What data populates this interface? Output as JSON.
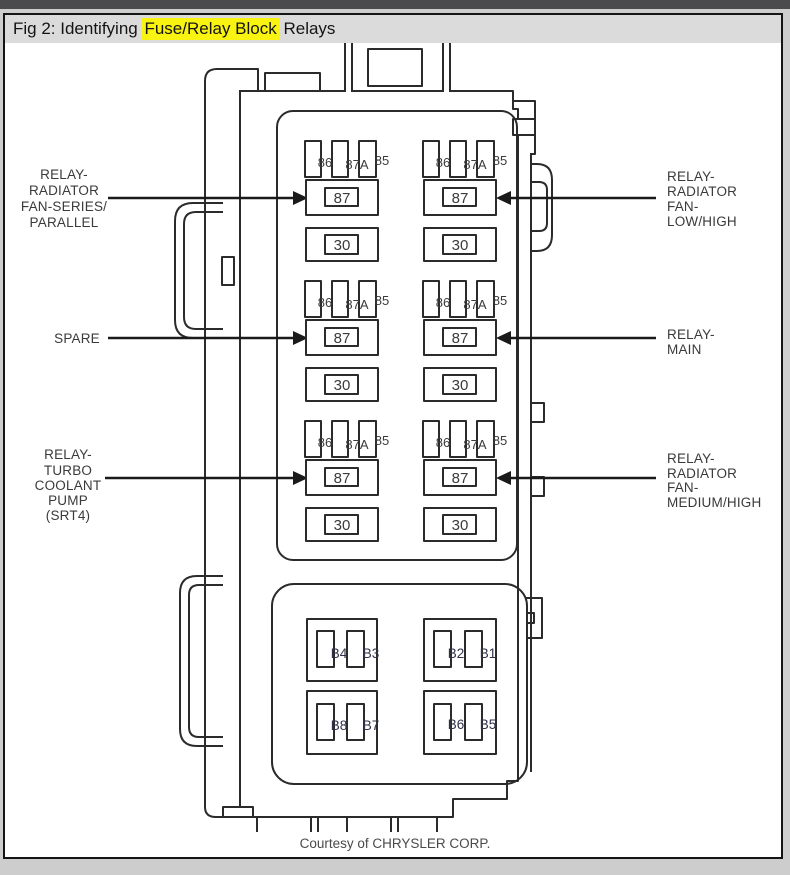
{
  "header": {
    "title_prefix": "Fig 2: Identifying ",
    "title_highlight": "Fuse/Relay Block",
    "title_suffix": " Relays",
    "highlight_color": "#f8f310",
    "background": "#dbdbdb"
  },
  "diagram": {
    "terminals": {
      "coil_a": "86",
      "coil_b": "87A",
      "coil_c": "85",
      "output": "87",
      "power": "30"
    },
    "callouts": {
      "left": [
        {
          "lines": [
            "RELAY-",
            "RADIATOR",
            "FAN-SERIES/",
            "PARALLEL"
          ]
        },
        {
          "lines": [
            "SPARE"
          ]
        },
        {
          "lines": [
            "RELAY-",
            "TURBO",
            "COOLANT",
            "PUMP",
            "(SRT4)"
          ]
        }
      ],
      "right": [
        {
          "lines": [
            "RELAY-",
            "RADIATOR",
            "FAN-",
            "LOW/HIGH"
          ]
        },
        {
          "lines": [
            "RELAY-",
            "MAIN"
          ]
        },
        {
          "lines": [
            "RELAY-",
            "RADIATOR",
            "FAN-",
            "MEDIUM/HIGH"
          ]
        }
      ]
    },
    "fuses": {
      "top_left": [
        "B4",
        "B3"
      ],
      "top_right": [
        "B2",
        "B1"
      ],
      "bottom_left": [
        "B8",
        "B7"
      ],
      "bottom_right": [
        "B6",
        "B5"
      ]
    },
    "footer": "Courtesy of CHRYSLER CORP."
  }
}
